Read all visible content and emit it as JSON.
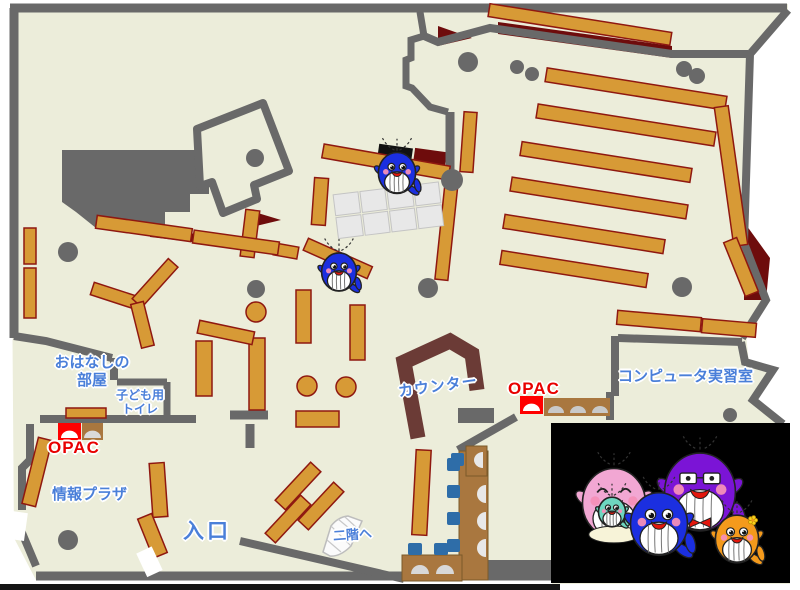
{
  "labels": {
    "story_room": [
      "おはなしの",
      "部屋"
    ],
    "kids_toilet": [
      "子ども用",
      "トイレ"
    ],
    "opac_left": "OPAC",
    "opac_right": "OPAC",
    "counter": "カウンター",
    "computer_room": "コンピュータ実習室",
    "info_plaza": "情報プラザ",
    "entrance": "入口",
    "to_second_floor": "二階へ"
  },
  "colors": {
    "floor": "#ECEDDA",
    "wall": "#696969",
    "shelf": "#D79A36",
    "shelf_border": "#8F1810",
    "dark_red": "#6E0C0C",
    "counter": "#6B3B36",
    "label_blue": "#4A7FD9",
    "label_red": "#E80000",
    "chair_blue": "#2E6DA8",
    "desk_brown": "#A9773F",
    "photo_background": "#000000"
  },
  "mascot_colors": {
    "blue": "#1B2FE0",
    "pink": "#F2A7D3",
    "purple": "#7B14D6",
    "orange": "#F49A1C",
    "baby": "#6ED6C0"
  },
  "mascots": {
    "floor_whales": [
      {
        "type": "blue",
        "x": 397,
        "y": 173,
        "s": 0.62
      },
      {
        "type": "blue",
        "x": 339,
        "y": 272,
        "s": 0.58
      }
    ],
    "family_photo": {
      "x": 551,
      "y": 423,
      "w": 239,
      "h": 160,
      "members": [
        {
          "type": "pink",
          "x": 614,
          "y": 503,
          "s": 1.05
        },
        {
          "type": "baby",
          "x": 612,
          "y": 512,
          "s": 0.45
        },
        {
          "type": "purple",
          "x": 700,
          "y": 492,
          "s": 1.18
        },
        {
          "type": "blue",
          "x": 659,
          "y": 524,
          "s": 0.95
        },
        {
          "type": "orange",
          "x": 737,
          "y": 539,
          "s": 0.72
        }
      ]
    }
  }
}
